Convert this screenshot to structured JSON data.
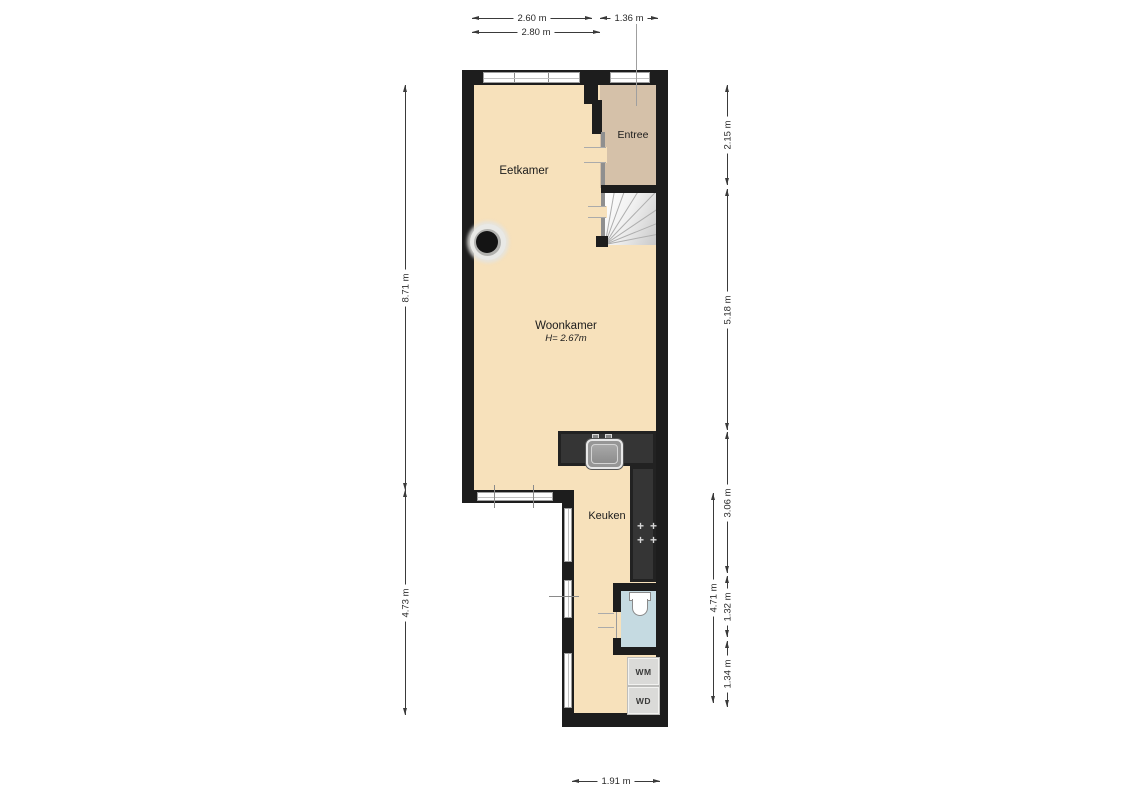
{
  "plan": {
    "rooms": {
      "eetkamer": {
        "label": "Eetkamer"
      },
      "entree": {
        "label": "Entree"
      },
      "woonkamer": {
        "label": "Woonkamer",
        "ceiling_height": "H= 2.67m"
      },
      "keuken": {
        "label": "Keuken"
      },
      "washer": {
        "label": "WM"
      },
      "dryer": {
        "label": "WD"
      }
    },
    "dimensions": {
      "top_upper_left": "2.60 m",
      "top_upper_right": "1.36 m",
      "top_lower": "2.80 m",
      "left_upper": "8.71 m",
      "left_lower": "4.73 m",
      "right_seg1": "2.15 m",
      "right_seg2": "5.18 m",
      "right_seg3": "3.06 m",
      "right_seg4": "1.32 m",
      "right_seg5": "1.34 m",
      "right_inner": "4.71 m",
      "bottom": "1.91 m"
    },
    "icons": {
      "stove_burner": "+"
    },
    "colors": {
      "wall": "#1d1d1d",
      "floor_main": "#f7e1bb",
      "floor_entree": "#d5c1a9",
      "floor_toilet": "#c5dae1",
      "counter": "#353535",
      "background": "#ffffff"
    }
  }
}
